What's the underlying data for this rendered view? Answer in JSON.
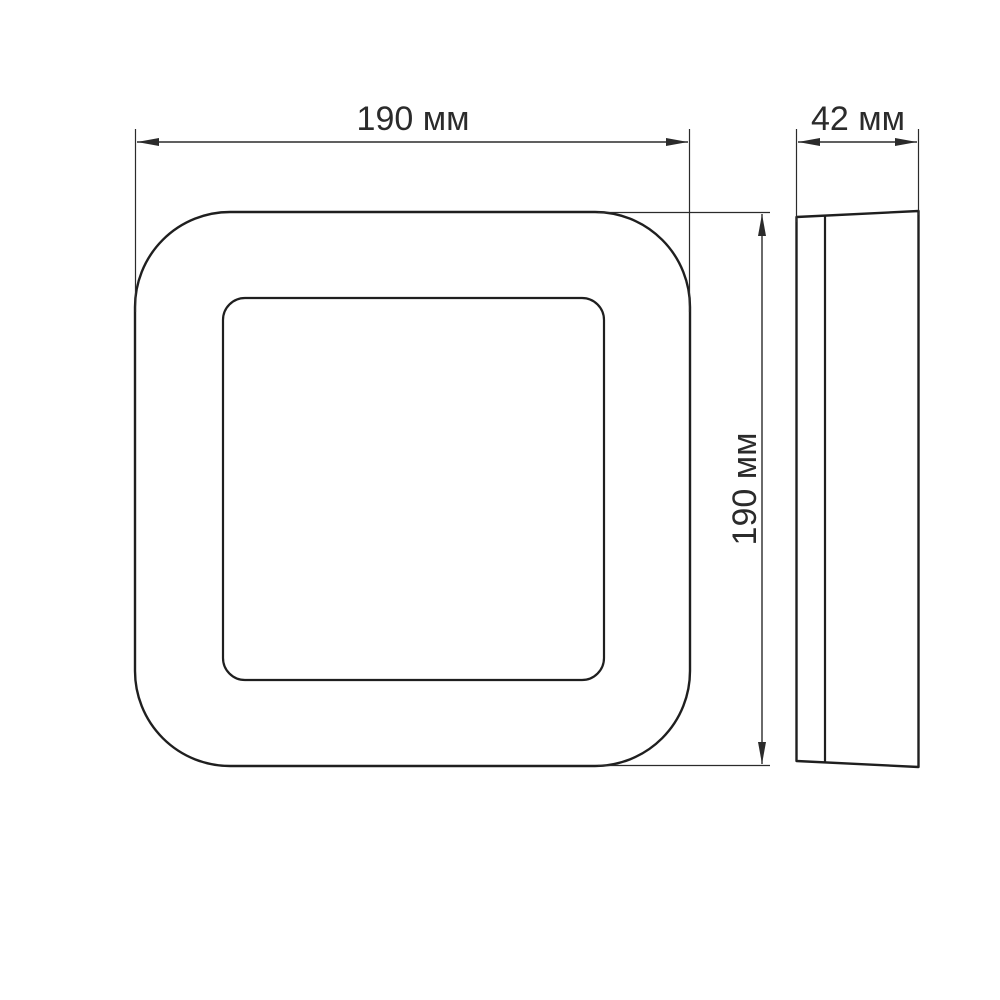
{
  "colors": {
    "background": "#ffffff",
    "line": "#2b2b2b",
    "shape": "#1f1f1f",
    "text": "#2b2b2b"
  },
  "drawing": {
    "front_view": {
      "width_label": "190 мм",
      "height_label": "190 мм"
    },
    "side_view": {
      "depth_label": "42 мм"
    }
  }
}
